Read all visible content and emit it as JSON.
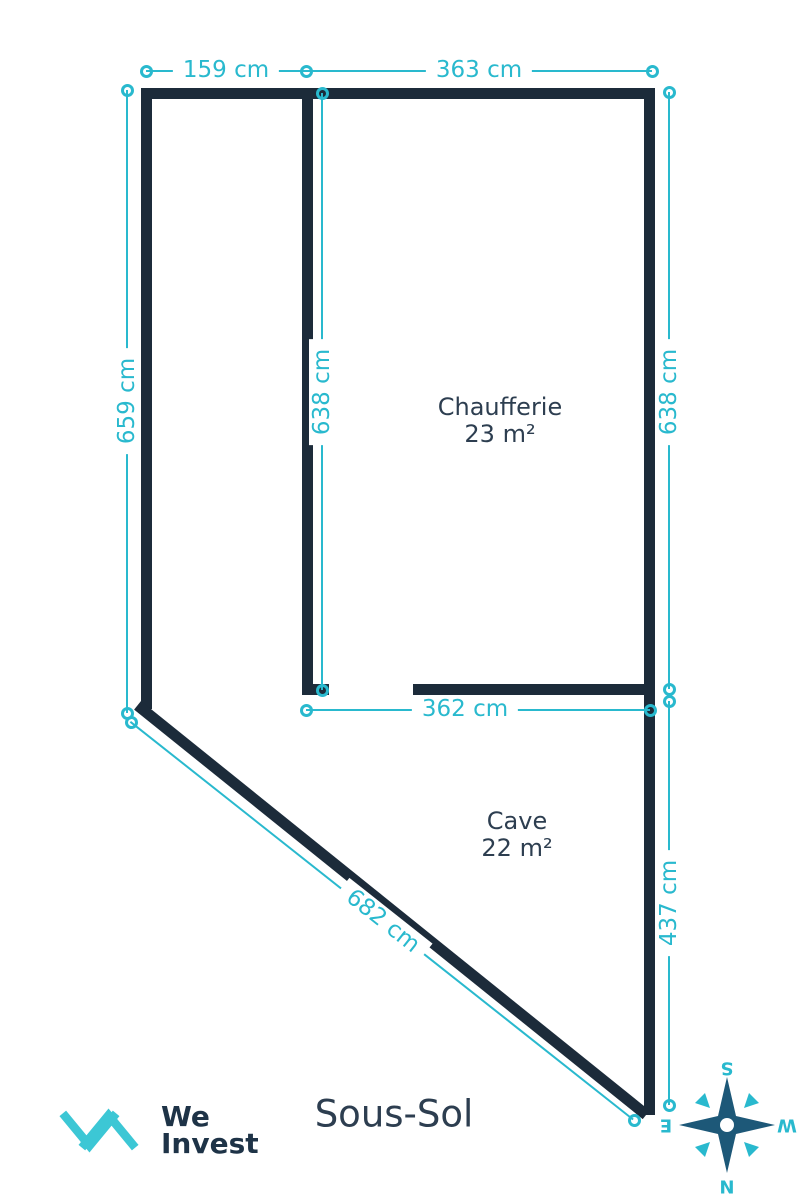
{
  "colors": {
    "wall": "#1c2b3a",
    "dim": "#29b9ce",
    "roomtext": "#2d3e50",
    "titletext": "#2d3e50",
    "logotext": "#1e3347",
    "logomark": "#3cc7d5",
    "compass": "#1d5878",
    "bg": "#ffffff"
  },
  "floor": {
    "title": "Sous-Sol"
  },
  "rooms": {
    "chaufferie": {
      "name": "Chaufferie",
      "area": "23 m²"
    },
    "cave": {
      "name": "Cave",
      "area": "22 m²"
    }
  },
  "dimensions": {
    "top_left": "159 cm",
    "top_right": "363 cm",
    "outer_left": "659 cm",
    "inner_middle": "638 cm",
    "outer_right_upper": "638 cm",
    "chaufferie_bottom": "362 cm",
    "outer_right_lower": "437 cm",
    "diagonal": "682 cm"
  },
  "logo": {
    "word1": "We",
    "word2": "Invest"
  },
  "compass": {
    "north": "N",
    "south": "S",
    "east": "E",
    "west": "W"
  }
}
